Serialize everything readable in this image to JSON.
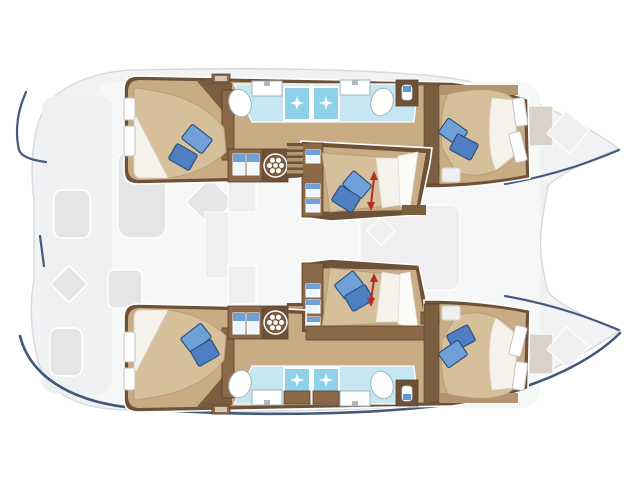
{
  "diagram": {
    "kind": "boat-floorplan",
    "view": "top-down",
    "vessel": "catamaran",
    "hulls": 2,
    "cabins": 6,
    "bathrooms": 2,
    "dimension_markers": 2
  },
  "rooms": [
    "aft-cabin-port",
    "bathroom-port",
    "forward-cabin-port",
    "nacelle-cabin-forward",
    "nacelle-cabin-aft",
    "aft-cabin-starboard",
    "bathroom-starboard",
    "forward-cabin-starboard",
    "cockpit-ghost",
    "salon-ghost",
    "bow-deck-ghost"
  ],
  "icons": [
    "sparkle-icon",
    "washer-icon",
    "toilet-icon",
    "sink-icon",
    "shower-icon",
    "vanity-icon",
    "pillow-icon",
    "stairs-icon",
    "locker-door-icon",
    "window-icon",
    "length-marker-icon",
    "sun-pad-icon",
    "cushion-icon"
  ],
  "colors": {
    "background": "#ffffff",
    "hull_ghost": "#f1f2f3",
    "hull_ghost_stroke": "#d8dadd",
    "ghost_furniture": "#e4e5e7",
    "ghost_furniture_stroke": "#ffffff",
    "navy_accent": "#44597e",
    "wood_dark": "#6d5138",
    "wood_mid": "#8a6848",
    "wood_light": "#c9ab84",
    "bed": "#d6c09c",
    "bedding_white": "#f5f2ec",
    "bath_floor": "#c6e7f2",
    "shower": "#8ed2e9",
    "sparkle": "#ffffff",
    "fixture_white": "#ffffff",
    "fixture_stroke": "#9fb4bd",
    "toilet_blue": "#5b9bd5",
    "pillow_light": "#6fa0d8",
    "pillow_dark": "#4d7fc2",
    "pillow_stroke": "#2c4a74",
    "locker_door_blue": "#6fa0d8",
    "marker_red": "#b03028"
  }
}
